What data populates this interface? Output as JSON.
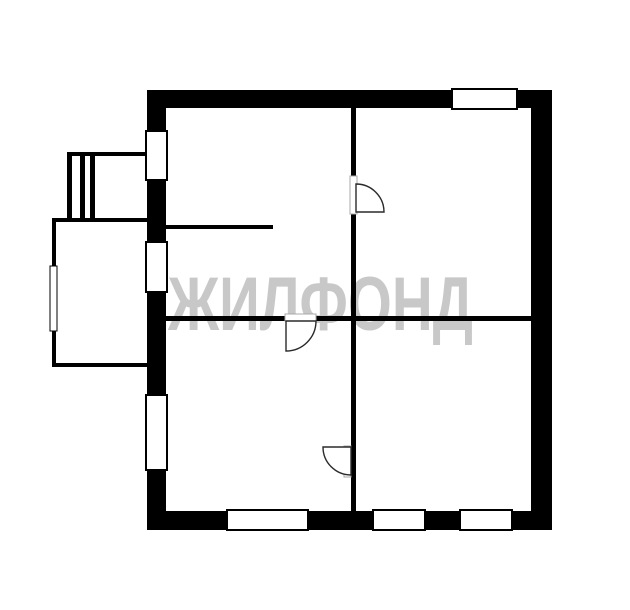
{
  "page": {
    "kind": "real-estate floor plan scan",
    "background": "#ffffff",
    "width": 630,
    "height": 610
  },
  "watermark": {
    "text": "ЖИЛФОНД",
    "color": "#c8c8c8"
  },
  "palette": {
    "wall": "#000000",
    "window_fill": "#ffffff",
    "window_stroke": "#000000",
    "door_stroke": "#2a2a2a",
    "door_fill": "#ffffff",
    "jamb_stroke": "#a8a8a8",
    "annex_line": "#000000"
  },
  "floorplan": {
    "walls": [
      {
        "name": "outer-wall-top",
        "rect": [
          148,
          90,
          404,
          18
        ]
      },
      {
        "name": "outer-wall-bottom",
        "rect": [
          148,
          511,
          404,
          19
        ]
      },
      {
        "name": "outer-wall-left",
        "rect": [
          147,
          90,
          19,
          440
        ]
      },
      {
        "name": "outer-wall-right",
        "rect": [
          531,
          90,
          21,
          440
        ]
      },
      {
        "name": "inner-wall-vertical",
        "rect": [
          351,
          108,
          5,
          403
        ]
      },
      {
        "name": "inner-wall-horizontal-left",
        "rect": [
          166,
          316,
          185,
          5
        ]
      },
      {
        "name": "inner-wall-horizontal-right",
        "rect": [
          356,
          316,
          175,
          5
        ]
      },
      {
        "name": "inner-wall-stub",
        "rect": [
          166,
          225,
          107,
          4
        ]
      }
    ],
    "windows": [
      {
        "name": "window-left-upper",
        "rect": [
          146,
          131,
          21,
          49
        ]
      },
      {
        "name": "window-left-middle",
        "rect": [
          146,
          242,
          21,
          50
        ]
      },
      {
        "name": "window-left-lower",
        "rect": [
          146,
          395,
          21,
          75
        ]
      },
      {
        "name": "window-top-right",
        "rect": [
          452,
          89,
          65,
          20
        ]
      },
      {
        "name": "window-bottom-left",
        "rect": [
          227,
          510,
          81,
          20
        ]
      },
      {
        "name": "window-bottom-mid",
        "rect": [
          373,
          510,
          52,
          20
        ]
      },
      {
        "name": "window-bottom-right",
        "rect": [
          460,
          510,
          52,
          20
        ]
      }
    ],
    "doors": [
      {
        "name": "door-upper-right-room",
        "jamb": [
          350,
          176,
          7,
          38
        ],
        "pie": "M 356 212 L 356 184 A 28 28 0 0 1 384 212 Z"
      },
      {
        "name": "door-lower-rooms",
        "jamb": [
          344,
          446,
          7,
          31
        ],
        "pie": "M 351 447 L 323 447 A 28 28 0 0 0 351 475 Z"
      },
      {
        "name": "door-lower-left-room",
        "jamb": [
          285,
          314,
          31,
          7
        ],
        "pie": "M 286 321 L 286 351 A 30 30 0 0 0 316 321 Z"
      }
    ],
    "annex": [
      {
        "name": "stairs-top-edge",
        "rect": [
          67,
          152,
          81,
          4
        ]
      },
      {
        "name": "stairs-bar-1",
        "rect": [
          67,
          152,
          5,
          68
        ]
      },
      {
        "name": "stairs-bar-2",
        "rect": [
          80,
          152,
          5,
          68
        ]
      },
      {
        "name": "stairs-bar-3",
        "rect": [
          90,
          152,
          5,
          68
        ]
      },
      {
        "name": "porch-top-edge",
        "rect": [
          52,
          218,
          96,
          4
        ]
      },
      {
        "name": "porch-left-edge",
        "rect": [
          52,
          218,
          4,
          149
        ]
      },
      {
        "name": "porch-bottom-edge",
        "rect": [
          52,
          363,
          96,
          4
        ]
      }
    ],
    "annex_windows": [
      {
        "name": "porch-window",
        "rect": [
          50,
          266,
          7,
          65
        ]
      }
    ]
  }
}
